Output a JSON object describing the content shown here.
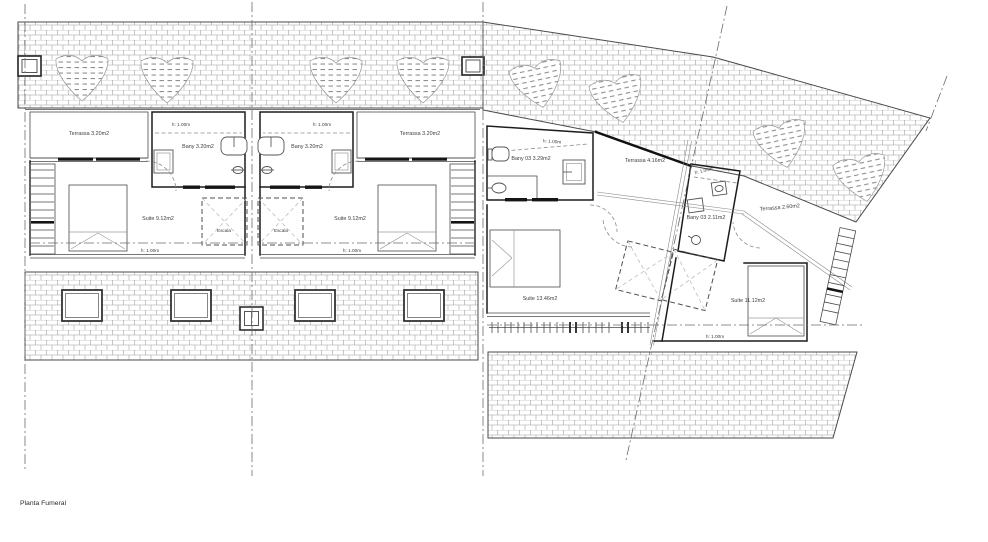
{
  "plan": {
    "caption": "Planta Fumeral",
    "colors": {
      "wall": "#1c1c1c",
      "hatch": "#9a9a9a",
      "text": "#3d3d3d",
      "background": "#ffffff"
    },
    "left_building": {
      "unit_a": {
        "terrassa": "Terrassa 3.20m2",
        "bany_h": "h: 1.00m",
        "bany": "Bany 3.20m2",
        "suite": "Suite 9.12m2",
        "escala": "Escala",
        "suite_h": "h: 1.00m"
      },
      "unit_b": {
        "terrassa": "Terrassa 3.20m2",
        "bany_h": "h: 1.00m",
        "bany": "Bany 3.20m2",
        "suite": "Suite 9.12m2",
        "escala": "Escala",
        "suite_h": "h: 1.00m"
      }
    },
    "right_building": {
      "unit_c": {
        "bany_h": "h: 1.00m",
        "bany": "Bany 03 3.29m2",
        "terrassa": "Terrassa 4.16m2",
        "suite": "Suite 13.46m2"
      },
      "unit_d": {
        "bany_h": "h: 1.00m",
        "bany": "Bany 03 2.11m2",
        "terrassa": "Terrassa 2.60m2",
        "suite": "Suite 11.12m2",
        "suite_h": "h: 1.00m"
      }
    }
  }
}
